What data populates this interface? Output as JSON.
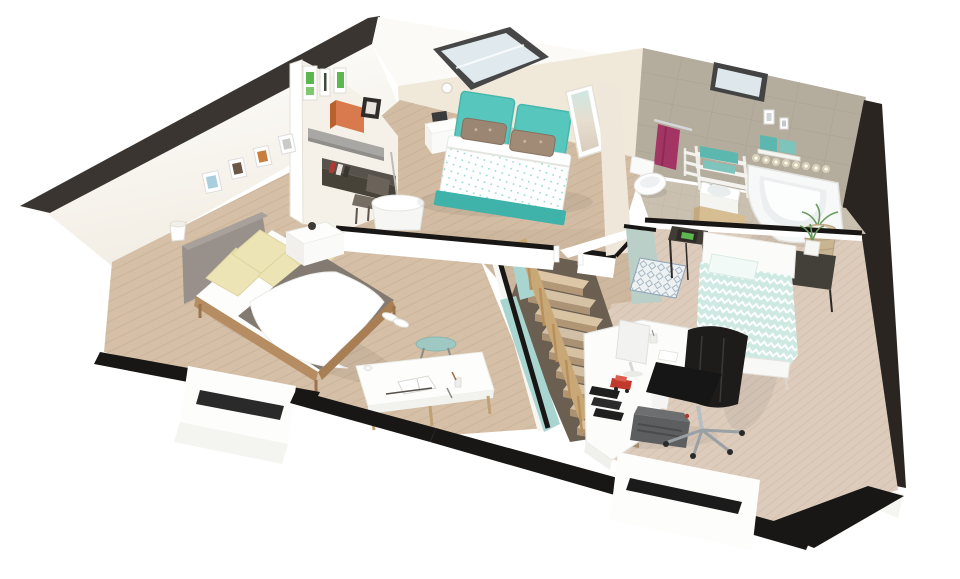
{
  "view": {
    "type": "3d-floorplan-cutaway-render",
    "level": "upper-floor-attic",
    "background": "#ffffff",
    "visible_text": "none"
  },
  "palette": {
    "roof_edge": "#3a3531",
    "cut_wall_black": "#191715",
    "east_wall_dark": "#2b2521",
    "wall_white": "#ffffff",
    "wall_cream": "#f0e9da",
    "tile_wall": "#b4ac9d",
    "bath_floor": "#c9c0af",
    "bath_floor_tan": "#d7bd92",
    "wood_floor_left": "#d5c0a7",
    "wood_floor_master": "#d2bda4",
    "wood_floor_hall": "#cdb89f",
    "wood_floor_bed3": "#ddccbc",
    "teal_bed": "#57c7be",
    "teal_dark": "#3fb3aa",
    "mint_duvet": "#cde9e2",
    "aqua_wall": "#a8d5cf",
    "sage_wall": "#b9cfc7",
    "teal_towel": "#5cb8ae",
    "magenta_towel": "#a23563",
    "orange_box": "#d97a4e",
    "green_art": "#5cb84e",
    "cream_pillow": "#ece4b4",
    "gray_blanket": "#837b71",
    "gray_headboard": "#98908a",
    "stair_rail": "#c9a877",
    "chair_black": "#1d1c1b",
    "typewriter": "#5d5e60",
    "red_car": "#c0392c",
    "rug_blue": "#8ba3b5",
    "skylight_frame": "#474747",
    "skylight_glass": "#dfe9ee"
  },
  "rooms": [
    {
      "id": "bedroom-left",
      "label": "bedroom with gray double bed",
      "items": [
        "upholstered gray double bed",
        "cream pillows",
        "gray blanket",
        "white throw",
        "white nightstand",
        "wall sconce",
        "four small picture frames",
        "white writing table with open notebook",
        "teal stool",
        "pair of white shoes",
        "dormer window cut in wall"
      ]
    },
    {
      "id": "master-bedroom",
      "label": "bedroom with teal double bed",
      "items": [
        "teal double bed with two headboard panels",
        "floral pillows",
        "white nightstand with radio alarm",
        "floor lamp with white drum shade",
        "three green art prints",
        "gray wall shelf with orange storage box",
        "dark floating wall desk",
        "wooden desk chair",
        "full-length mirror",
        "roof skylight",
        "smoke detector"
      ]
    },
    {
      "id": "bathroom",
      "label": "bathroom",
      "items": [
        "corner bathtub",
        "spotlight strip above tub",
        "wall-hung toilet",
        "magenta towel on chrome rail",
        "white towel ladder with teal towels",
        "washbasin on tan cabinet",
        "wall shelf with teal towels",
        "soap dispenser frames",
        "wicker basket with plant",
        "roof window",
        "gray wall tiles"
      ]
    },
    {
      "id": "landing-stairs",
      "label": "landing and staircase",
      "items": [
        "wooden staircase",
        "wood balustrade railing",
        "aqua stairwell half-wall",
        "door openings with black wall caps"
      ]
    },
    {
      "id": "bedroom-office",
      "label": "bedroom with office corner",
      "items": [
        "single bed with mint chevron duvet",
        "white headboard",
        "dark metal nightstand with framed photo",
        "dark metal nightstand with potted plant",
        "patterned blue rug",
        "sage accent wall",
        "white corner desk",
        "white monitor",
        "black office chair on casters",
        "vintage gray typewriter",
        "red toy car",
        "black letter trays"
      ]
    }
  ],
  "structure": [
    "dark sloped roof cut edge",
    "black cut wall caps",
    "white cut outer wall stubs",
    "window slots in cut walls",
    "light wood plank flooring",
    "beige tiled bathroom floor"
  ]
}
